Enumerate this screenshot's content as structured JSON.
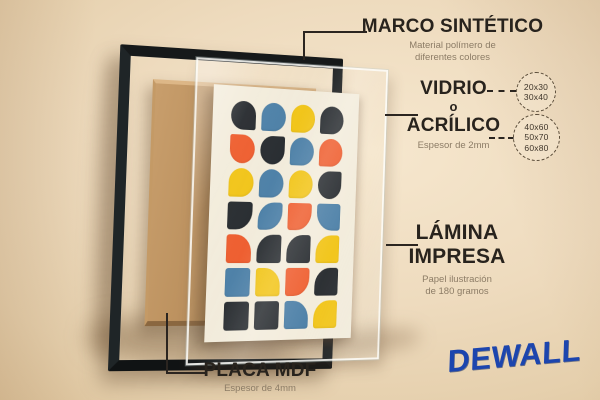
{
  "annotations": {
    "frame": {
      "title": "MARCO SINTÉTICO",
      "subtitle_line1": "Material polímero de",
      "subtitle_line2": "diferentes colores"
    },
    "glazing": {
      "line1": "VIDRIO",
      "line2": "o",
      "line3": "ACRÍLICO",
      "subtitle": "Espesor de 2mm",
      "sizes_small": [
        "20x30",
        "30x40"
      ],
      "sizes_large": [
        "40x60",
        "50x70",
        "60x80"
      ]
    },
    "print": {
      "line1": "LÁMINA",
      "line2": "IMPRESA",
      "subtitle_line1": "Papel ilustración",
      "subtitle_line2": "de 180 gramos"
    },
    "backing": {
      "title": "PLACA MDF",
      "subtitle": "Espesor de 4mm"
    }
  },
  "brand": {
    "name": "DEWALL",
    "color": "#1c45ae"
  },
  "scene": {
    "wall_color": "#ecd9bd",
    "frame_color": "#16191a",
    "mdf_color": "#b58a57",
    "paper_color": "#f3ecdb"
  },
  "artwork": {
    "palette": {
      "dark": "#24282c",
      "blue": "#4a7ea6",
      "yellow": "#f2c414",
      "orange": "#ef5b2b"
    },
    "grid": {
      "columns": 4,
      "rows": 7
    },
    "cells": [
      {
        "color": "dark",
        "rounded": [
          "tl",
          "tr",
          "bl"
        ]
      },
      {
        "color": "blue",
        "rounded": [
          "tl",
          "tr",
          "br"
        ]
      },
      {
        "color": "yellow",
        "rounded": [
          "tl",
          "tr",
          "br"
        ]
      },
      {
        "color": "dark",
        "rounded": [
          "tl",
          "tr",
          "br"
        ]
      },
      {
        "color": "orange",
        "rounded": [
          "tr",
          "br",
          "bl"
        ]
      },
      {
        "color": "dark",
        "rounded": [
          "tl",
          "br",
          "bl"
        ]
      },
      {
        "color": "blue",
        "rounded": [
          "tl",
          "tr",
          "br"
        ]
      },
      {
        "color": "orange",
        "rounded": [
          "tl",
          "tr",
          "br"
        ]
      },
      {
        "color": "yellow",
        "rounded": [
          "tl",
          "tr",
          "br"
        ]
      },
      {
        "color": "blue",
        "rounded": [
          "tl",
          "tr",
          "br"
        ]
      },
      {
        "color": "yellow",
        "rounded": [
          "tl",
          "tr",
          "br"
        ]
      },
      {
        "color": "dark",
        "rounded": [
          "tl",
          "br",
          "bl"
        ]
      },
      {
        "color": "dark",
        "rounded": [
          "br"
        ]
      },
      {
        "color": "blue",
        "rounded": [
          "tl",
          "br"
        ]
      },
      {
        "color": "orange",
        "rounded": [
          "br"
        ]
      },
      {
        "color": "blue",
        "rounded": [
          "bl"
        ]
      },
      {
        "color": "orange",
        "rounded": [
          "tr"
        ]
      },
      {
        "color": "dark",
        "rounded": [
          "tl"
        ]
      },
      {
        "color": "dark",
        "rounded": [
          "tl"
        ]
      },
      {
        "color": "yellow",
        "rounded": [
          "tl"
        ]
      },
      {
        "color": "blue",
        "rounded": []
      },
      {
        "color": "yellow",
        "rounded": [
          "tr"
        ]
      },
      {
        "color": "orange",
        "rounded": [
          "br"
        ]
      },
      {
        "color": "dark",
        "rounded": [
          "tl"
        ]
      },
      {
        "color": "dark",
        "rounded": []
      },
      {
        "color": "dark",
        "rounded": []
      },
      {
        "color": "blue",
        "rounded": [
          "tr"
        ]
      },
      {
        "color": "yellow",
        "rounded": [
          "tl"
        ]
      }
    ]
  }
}
